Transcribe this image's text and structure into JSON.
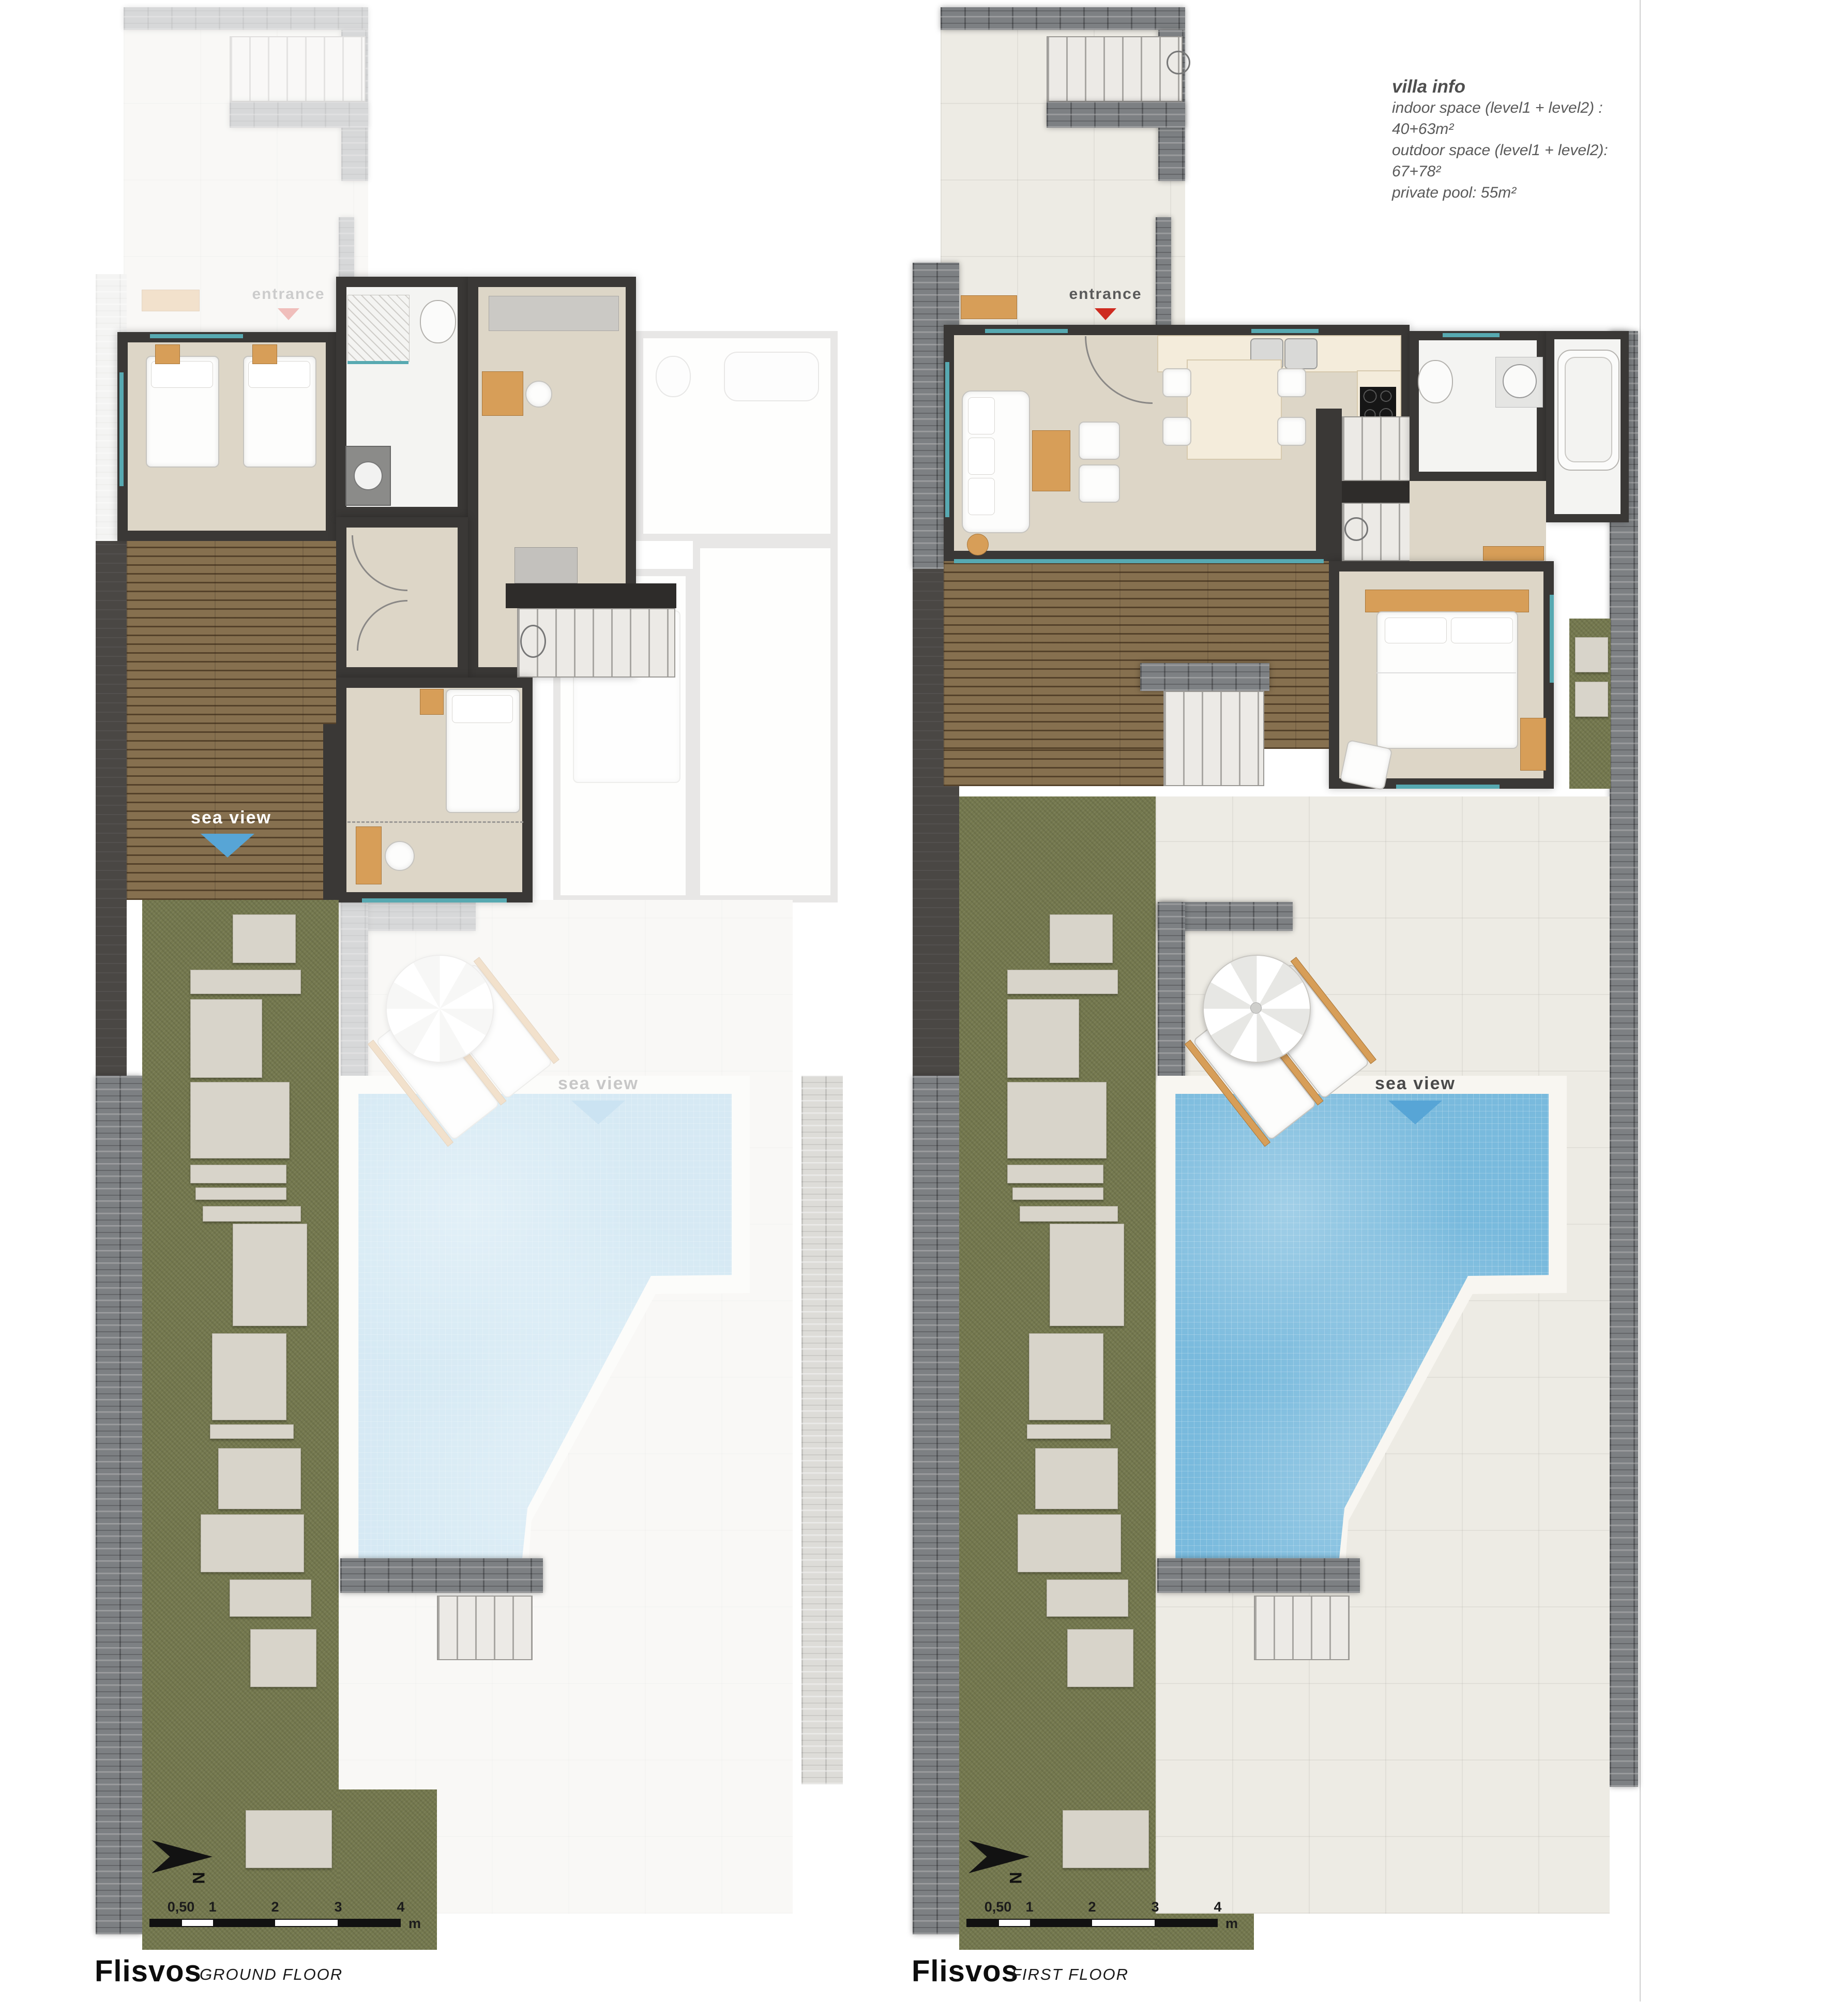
{
  "villa_info": {
    "title": "villa info",
    "lines": [
      "indoor space (level1 + level2) : 40+63m²",
      "outdoor space (level1 + level2): 67+78²",
      "private pool: 55m²"
    ]
  },
  "plans": [
    {
      "name": "Flisvos",
      "floor": "GROUND FLOOR",
      "entrance_label": "entrance",
      "sea_view_label": "sea view",
      "north_label": "N",
      "scale_labels": [
        "0,50",
        "1",
        "2",
        "3",
        "4"
      ],
      "scale_unit": "m"
    },
    {
      "name": "Flisvos",
      "floor": "FIRST FLOOR",
      "entrance_label": "entrance",
      "sea_view_label": "sea view",
      "north_label": "N",
      "scale_labels": [
        "0,50",
        "1",
        "2",
        "3",
        "4"
      ],
      "scale_unit": "m"
    }
  ],
  "colors": {
    "wall": "#3a3836",
    "lawn": "#75794f",
    "pool_water": "#79badd",
    "wood_accent": "#d79e58",
    "sea_view_arrow": "#57a5d6",
    "entrance_arrow": "#ce2b20"
  }
}
